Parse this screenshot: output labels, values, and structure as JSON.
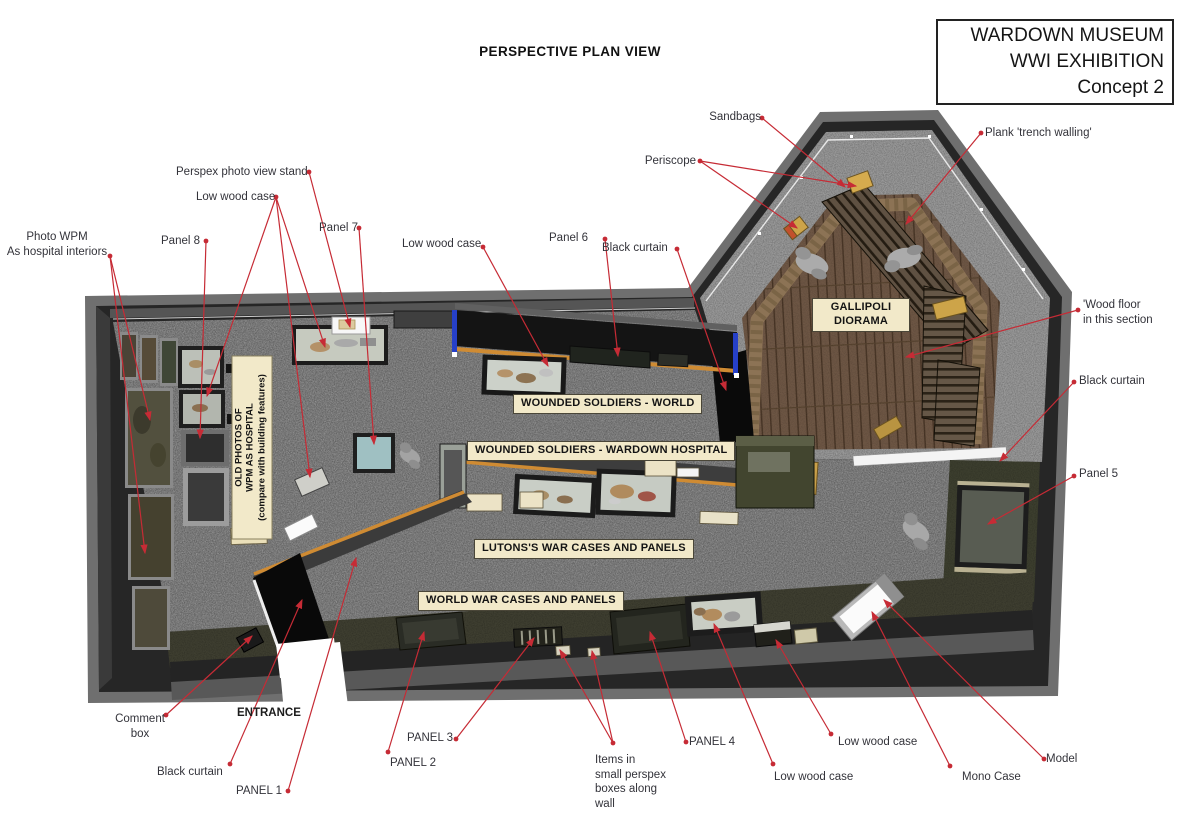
{
  "header": {
    "plan_title": "PERSPECTIVE PLAN VIEW"
  },
  "title_block": {
    "line1": "WARDOWN MUSEUM",
    "line2": "WWI EXHIBITION",
    "line3": "Concept 2"
  },
  "zones": {
    "gallipoli": "GALLIPOLI\nDIORAMA",
    "wounded_world": "WOUNDED SOLDIERS - WORLD",
    "wounded_wardown": "WOUNDED SOLDIERS - WARDOWN HOSPITAL",
    "lutons": "LUTONS'S WAR CASES AND PANELS",
    "world_war": "WORLD WAR CASES AND PANELS",
    "old_photos": "OLD PHOTOS OF\nWPM AS HOSPITAL\n(compare with building features)",
    "entrance": "ENTRANCE"
  },
  "annotations": {
    "sandbags": "Sandbags",
    "periscope": "Periscope",
    "plank_trench": "Plank 'trench walling'",
    "perspex_stand": "Perspex photo view stand",
    "low_wood_case_top": "Low wood case",
    "photo_wpm": "Photo WPM\nAs hospital interiors",
    "panel_8": "Panel 8",
    "panel_7": "Panel 7",
    "low_wood_case_mid": "Low wood case",
    "panel_6": "Panel 6",
    "black_curtain_top": "Black curtain",
    "wood_floor": "'Wood floor\nin this section",
    "black_curtain_right": "Black curtain",
    "panel_5": "Panel 5",
    "comment_box": "Comment\nbox",
    "black_curtain_entrance": "Black curtain",
    "panel_1": "PANEL 1",
    "panel_2": "PANEL 2",
    "panel_3": "PANEL 3",
    "items_perspex": "Items in\nsmall perspex\nboxes along\nwall",
    "panel_4": "PANEL 4",
    "low_wood_case_bottom_mid": "Low wood case",
    "low_wood_case_bottom_right": "Low wood case",
    "mono_case": "Mono Case",
    "model": "Model"
  },
  "colors": {
    "annotation_red": "#c62b35",
    "zone_label_cream": "#f2e9c9",
    "orange_stripe": "#cf8b33",
    "carpet_gray": "#7c7c7c",
    "wood_brown": "#6d5644",
    "wall_dark": "#262626",
    "curtain_black": "#0a0a0a"
  }
}
